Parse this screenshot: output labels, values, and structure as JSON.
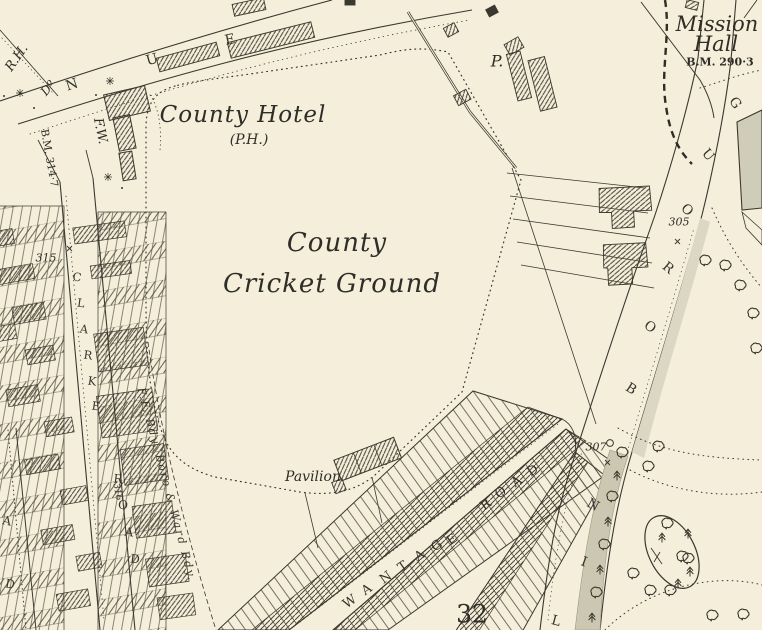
{
  "map": {
    "colors": {
      "paper": "#f4eeda",
      "ink": "#3b382f",
      "gray_band": "#cbc7b0",
      "gray_building": "#cfccba",
      "stipple": "#dcd7c2"
    },
    "labels": {
      "county_hotel": "County Hotel",
      "county_hotel_ph": "(P.H.)",
      "ground_line1": "County",
      "ground_line2": "Cricket Ground",
      "pavilion": "Pavilion",
      "mission_line1": "Mission",
      "mission_line2": "Hall",
      "bm_290": "B.M. 290·3",
      "bm_314": "B.M. 314·7",
      "p_abbrev": "P.",
      "rh_abbrev": "R.H.",
      "ditto_abbrev": "Dº",
      "fw_abbrev": "F.W.",
      "boundary_text": "F.F. Bdy. Boro & Ward Bdy.",
      "num_315": "315",
      "num_316": "316",
      "num_305": "305",
      "num_307": "307",
      "num_32": "32"
    },
    "road_letters": {
      "avenue": [
        "N",
        "U",
        "E"
      ],
      "clarke": [
        "C",
        "L",
        "A",
        "R",
        "K",
        "E"
      ],
      "clarke_road": [
        "R",
        "O",
        "A",
        "D"
      ],
      "left_edge_road": [
        "A",
        "D"
      ],
      "wantage": [
        "W",
        "A",
        "N",
        "T",
        "A",
        "G",
        "E"
      ],
      "wantage_road": [
        "R",
        "O",
        "A",
        "D"
      ],
      "wellingborough": [
        "L",
        "I",
        "N",
        "B",
        "O",
        "R",
        "O",
        "U",
        "G"
      ]
    }
  }
}
